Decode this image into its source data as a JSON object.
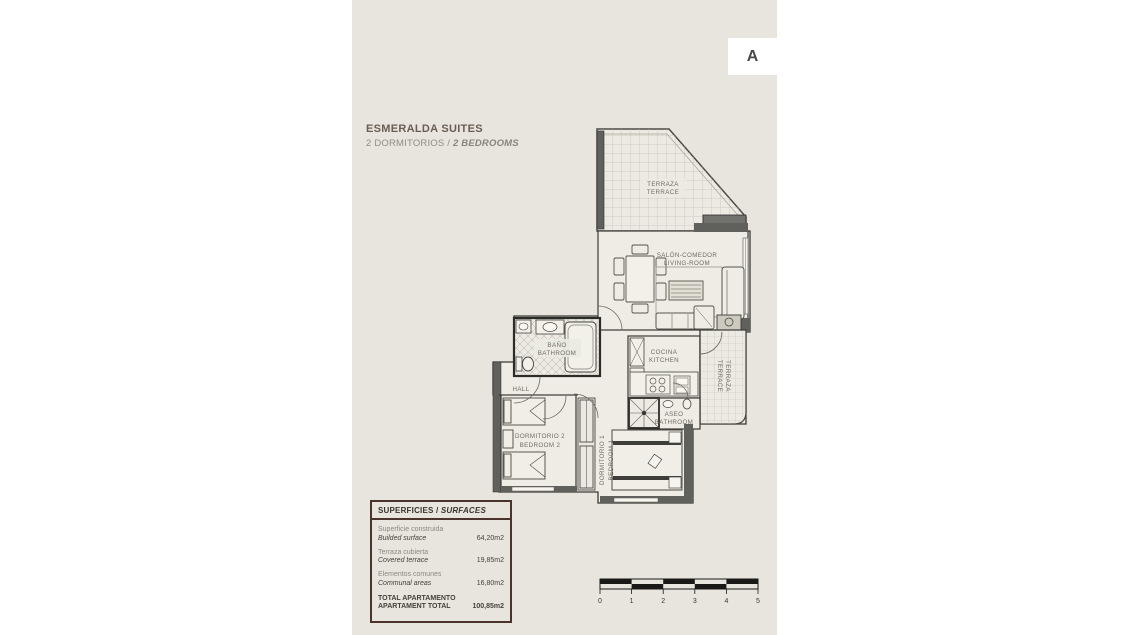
{
  "page": {
    "letter": "A"
  },
  "header": {
    "title": "ESMERALDA SUITES",
    "subtitle_es": "2 DORMITORIOS / ",
    "subtitle_en": "2 BEDROOMS"
  },
  "plan": {
    "rooms": {
      "terrace_top": {
        "es": "TERRAZA",
        "en": "TERRACE"
      },
      "living": {
        "es": "SALÓN-COMEDOR",
        "en": "LIVING-ROOM"
      },
      "bathroom": {
        "es": "BAÑO",
        "en": "BATHROOM"
      },
      "kitchen": {
        "es": "COCINA",
        "en": "KITCHEN"
      },
      "terrace_side": {
        "es": "TERRAZA",
        "en": "TERRACE"
      },
      "aseo": {
        "es": "ASEO",
        "en": "BATHROOM"
      },
      "hall": {
        "es": "HALL"
      },
      "bedroom2": {
        "es": "DORMITORIO 2",
        "en": "BEDROOM 2"
      },
      "bedroom1": {
        "es": "DORMITORIO 1",
        "en": "BEDROOM 1"
      }
    }
  },
  "surfaces": {
    "title_es": "SUPERFICIES / ",
    "title_en": "SURFACES",
    "rows": [
      {
        "es": "Superficie construida",
        "en": "Builded surface",
        "value": "64,20m2"
      },
      {
        "es": "Terraza cubierta",
        "en": "Covered terrace",
        "value": "19,85m2"
      },
      {
        "es": "Elementos comunes",
        "en": "Communal areas",
        "value": "16,80m2"
      }
    ],
    "total": {
      "es": "TOTAL APARTAMENTO",
      "en": "APARTAMENT TOTAL",
      "value": "100,85m2"
    }
  },
  "scalebar": {
    "labels": [
      "0",
      "1",
      "2",
      "3",
      "4",
      "5"
    ]
  },
  "colors": {
    "page_bg": "#e7e5dd",
    "wall_dark": "#60605d",
    "plan_line": "#3c3a36",
    "table_border": "#4c332b",
    "title_text": "#6a5d54",
    "subtitle_text": "#8f8d85",
    "room_label": "#6f6c64"
  }
}
